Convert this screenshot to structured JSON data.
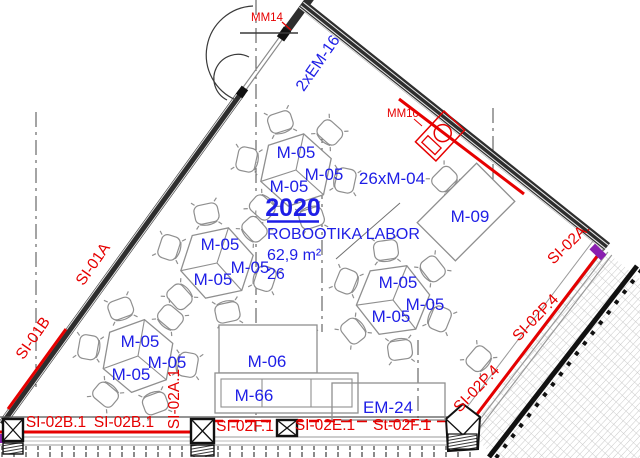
{
  "colors": {
    "blue": "#1e1ee6",
    "red": "#e60000",
    "wall": "#2e2e2e",
    "furn": "#8f8f8f",
    "purple": "#8a1fb0"
  },
  "room": {
    "number": "2020",
    "name": "ROBOOTIKA LABOR",
    "area": "62,9 m²",
    "occupancy": "26"
  },
  "furniture": {
    "group_table": "M-05",
    "teacher_desk": "M-09",
    "cabinet": "M-06",
    "shelf": "M-66",
    "equipment": "EM-24",
    "chairs": "26xM-04"
  },
  "fittings": {
    "door_tag": "MM14",
    "device_tag": "MM1c",
    "element_tag": "2xEM-16"
  },
  "wall_tags": {
    "left_upper": "SI-01A",
    "left_lower": "SI-01B",
    "bottom_left_1": "SI-02B.1",
    "bottom_left_2": "SI-02B.1",
    "pier": "SI-02A.1",
    "bottom_mid_1": "SI-02F.1",
    "bottom_mid_2": "SI-02E.1",
    "bottom_mid_3": "St-02F.1",
    "diag_upper": "SI-02P.4",
    "diag_lower": "SI-02P.4",
    "corner": "SI-02A."
  }
}
